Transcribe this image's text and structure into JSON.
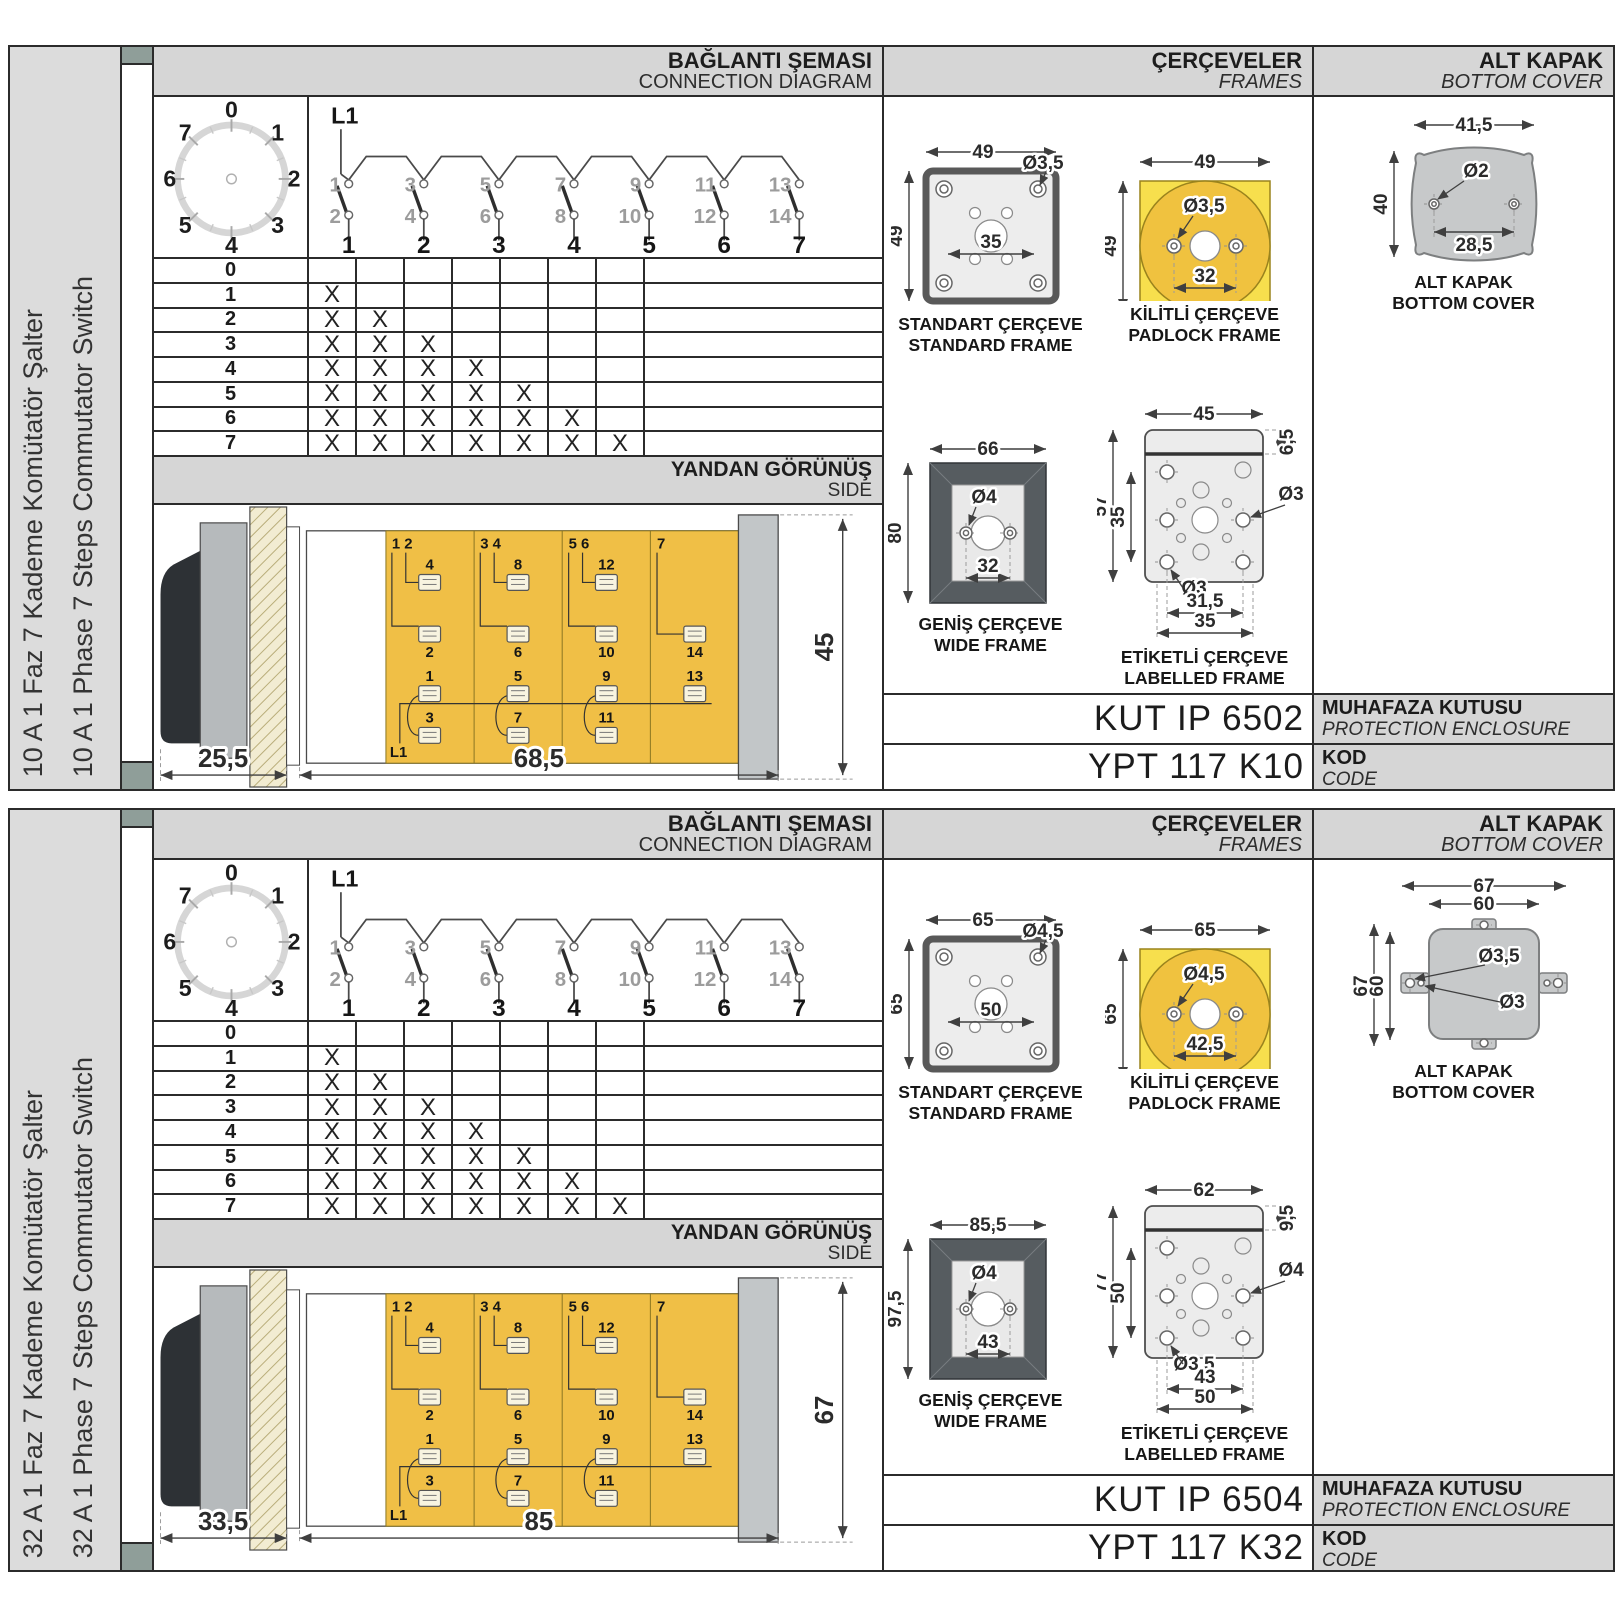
{
  "colors": {
    "panel_border": "#2b2b2b",
    "band_gray": "#d6d6d6",
    "sidebar_gray": "#dcdcdc",
    "tab_gray": "#8f9e99",
    "body_yellow": "#f0bf46",
    "padlock_yellow": "#f7df4d",
    "padlock_circle": "#f0c23f",
    "wide_frame_dark": "#565c60",
    "cover_gray": "#c7c9ca",
    "hatch_beige": "#f2ecd2"
  },
  "panels": [
    {
      "sidebar": {
        "title_tr": "10 A 1 Faz 7 Kademe Komütatör Şalter",
        "title_en": "10 A 1 Phase 7 Steps Commutator Switch"
      },
      "headers": {
        "conn_tr": "BAĞLANTI ŞEMASI",
        "conn_en": "CONNECTION DIAGRAM",
        "frames_tr": "ÇERÇEVELER",
        "frames_en": "FRAMES",
        "cover_tr": "ALT KAPAK",
        "cover_en": "BOTTOM COVER",
        "side_tr": "YANDAN GÖRÜNÜŞ",
        "side_en": "SIDE"
      },
      "dial": {
        "positions": [
          "0",
          "1",
          "2",
          "3",
          "4",
          "5",
          "6",
          "7"
        ]
      },
      "diagram": {
        "feed": "L1",
        "top_contacts": [
          "1",
          "3",
          "5",
          "7",
          "9",
          "11",
          "13"
        ],
        "bottom_contacts": [
          "2",
          "4",
          "6",
          "8",
          "10",
          "12",
          "14"
        ],
        "outputs": [
          "1",
          "2",
          "3",
          "4",
          "5",
          "6",
          "7"
        ]
      },
      "step_table": {
        "mark": "X",
        "rows": [
          {
            "label": "0",
            "marks": 0
          },
          {
            "label": "1",
            "marks": 1
          },
          {
            "label": "2",
            "marks": 2
          },
          {
            "label": "3",
            "marks": 3
          },
          {
            "label": "4",
            "marks": 4
          },
          {
            "label": "5",
            "marks": 5
          },
          {
            "label": "6",
            "marks": 6
          },
          {
            "label": "7",
            "marks": 7
          }
        ]
      },
      "side": {
        "dims": {
          "front": "25,5",
          "body": "68,5",
          "height": "45"
        },
        "corner": [
          "1 2",
          "3 4",
          "5 6",
          "7"
        ],
        "term_top": [
          "4",
          "8",
          "12"
        ],
        "term_mid": [
          "2",
          "6",
          "10",
          "14"
        ],
        "term_low": [
          "1",
          "5",
          "9",
          "13"
        ],
        "term_bot": [
          "3",
          "7",
          "11"
        ],
        "feed": "L1"
      },
      "frames": {
        "standard": {
          "tr": "STANDART ÇERÇEVE",
          "en": "STANDARD FRAME",
          "w": "49",
          "h": "49",
          "hole": "Ø3,5",
          "span": "35"
        },
        "padlock": {
          "tr": "KİLİTLİ ÇERÇEVE",
          "en": "PADLOCK FRAME",
          "w": "49",
          "h": "49",
          "hole": "Ø3,5",
          "span": "32"
        },
        "wide": {
          "tr": "GENİŞ ÇERÇEVE",
          "en": "WIDE FRAME",
          "w": "66",
          "h": "80",
          "hole": "Ø4",
          "span": "32"
        },
        "labelled": {
          "tr": "ETİKETLİ ÇERÇEVE",
          "en": "LABELLED FRAME",
          "w": "45",
          "h": "57",
          "tab": "6,5",
          "inner_h": "35",
          "hole_right": "Ø3",
          "hole_left": "Ø3",
          "span1": "31,5",
          "span2": "35"
        }
      },
      "cover": {
        "tr": "ALT KAPAK",
        "en": "BOTTOM COVER",
        "w": "41,5",
        "h": "40",
        "hole": "Ø2",
        "span": "28,5"
      },
      "codes": {
        "enclosure": "KUT IP 6502",
        "enclosure_tr": "MUHAFAZA KUTUSU",
        "enclosure_en": "PROTECTION ENCLOSURE",
        "code": "YPT 117 K10",
        "code_tr": "KOD",
        "code_en": "CODE"
      }
    },
    {
      "sidebar": {
        "title_tr": "32 A 1 Faz 7 Kademe Komütatör Şalter",
        "title_en": "32 A 1 Phase 7 Steps Commutator Switch"
      },
      "headers": {
        "conn_tr": "BAĞLANTI ŞEMASI",
        "conn_en": "CONNECTION DIAGRAM",
        "frames_tr": "ÇERÇEVELER",
        "frames_en": "FRAMES",
        "cover_tr": "ALT KAPAK",
        "cover_en": "BOTTOM COVER",
        "side_tr": "YANDAN GÖRÜNÜŞ",
        "side_en": "SIDE"
      },
      "dial": {
        "positions": [
          "0",
          "1",
          "2",
          "3",
          "4",
          "5",
          "6",
          "7"
        ]
      },
      "diagram": {
        "feed": "L1",
        "top_contacts": [
          "1",
          "3",
          "5",
          "7",
          "9",
          "11",
          "13"
        ],
        "bottom_contacts": [
          "2",
          "4",
          "6",
          "8",
          "10",
          "12",
          "14"
        ],
        "outputs": [
          "1",
          "2",
          "3",
          "4",
          "5",
          "6",
          "7"
        ]
      },
      "step_table": {
        "mark": "X",
        "rows": [
          {
            "label": "0",
            "marks": 0
          },
          {
            "label": "1",
            "marks": 1
          },
          {
            "label": "2",
            "marks": 2
          },
          {
            "label": "3",
            "marks": 3
          },
          {
            "label": "4",
            "marks": 4
          },
          {
            "label": "5",
            "marks": 5
          },
          {
            "label": "6",
            "marks": 6
          },
          {
            "label": "7",
            "marks": 7
          }
        ]
      },
      "side": {
        "dims": {
          "front": "33,5",
          "body": "85",
          "height": "67"
        },
        "corner": [
          "1 2",
          "3 4",
          "5 6",
          "7"
        ],
        "term_top": [
          "4",
          "8",
          "12"
        ],
        "term_mid": [
          "2",
          "6",
          "10",
          "14"
        ],
        "term_low": [
          "1",
          "5",
          "9",
          "13"
        ],
        "term_bot": [
          "3",
          "7",
          "11"
        ],
        "feed": "L1"
      },
      "frames": {
        "standard": {
          "tr": "STANDART ÇERÇEVE",
          "en": "STANDARD FRAME",
          "w": "65",
          "h": "65",
          "hole": "Ø4,5",
          "span": "50"
        },
        "padlock": {
          "tr": "KİLİTLİ ÇERÇEVE",
          "en": "PADLOCK FRAME",
          "w": "65",
          "h": "65",
          "hole": "Ø4,5",
          "span": "42,5"
        },
        "wide": {
          "tr": "GENİŞ ÇERÇEVE",
          "en": "WIDE FRAME",
          "w": "85,5",
          "h": "97,5",
          "hole": "Ø4",
          "span": "43"
        },
        "labelled": {
          "tr": "ETİKETLİ ÇERÇEVE",
          "en": "LABELLED FRAME",
          "w": "62",
          "h": "77",
          "tab": "9,5",
          "inner_h": "50",
          "hole_right": "Ø4",
          "hole_left": "Ø3,5",
          "span1": "43",
          "span2": "50"
        }
      },
      "cover": {
        "tr": "ALT KAPAK",
        "en": "BOTTOM COVER",
        "w": "67",
        "w2": "60",
        "h": "67",
        "h2": "60",
        "hole": "Ø3,5",
        "hole2": "Ø3"
      },
      "codes": {
        "enclosure": "KUT IP 6504",
        "enclosure_tr": "MUHAFAZA KUTUSU",
        "enclosure_en": "PROTECTION ENCLOSURE",
        "code": "YPT 117 K32",
        "code_tr": "KOD",
        "code_en": "CODE"
      }
    }
  ]
}
